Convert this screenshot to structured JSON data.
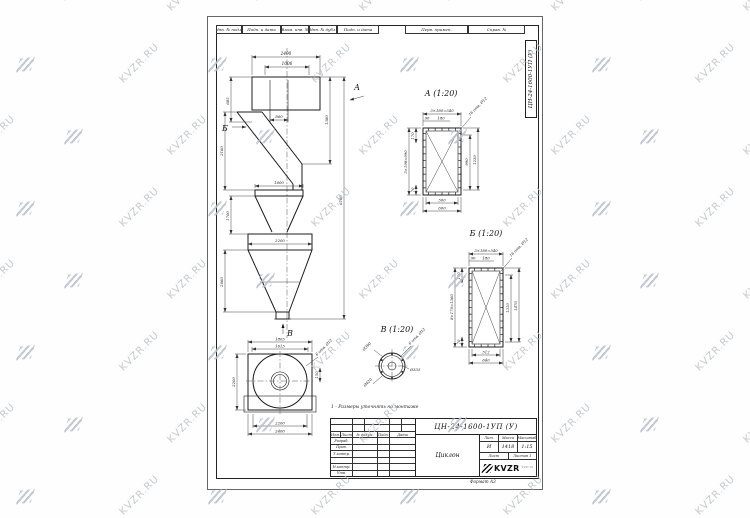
{
  "watermark": {
    "text": "KVZR.RU"
  },
  "sheet": {
    "top_strip": [
      "Инв. № подл.",
      "Подп. и дата",
      "Взам. инв. №",
      "Инв. № дубл.",
      "Подп. и дата"
    ],
    "top_right_cells": [
      "Перв. примен.",
      "Справ. №"
    ],
    "side_doc_number": "ЦН-24-1600-1УП (У)"
  },
  "front_view": {
    "label_a": "А",
    "label_b": "Б",
    "label_v": "В",
    "d2400": "2400",
    "d1006": "1006",
    "d860": "860",
    "d1600": "1600",
    "d2200": "2200",
    "l1": "685",
    "l2": "2160",
    "l3": "1700",
    "l4": "2060",
    "r1": "1380",
    "r2": "6160"
  },
  "section_a": {
    "title": "А (1:20)",
    "d540": "3×180=540",
    "d90": "90",
    "d180": "180",
    "holes": "16 отв. Ø12",
    "dleft": "5×198=990",
    "d170": "170",
    "d70": "70",
    "d990": "990",
    "d1230": "1230",
    "d500": "500",
    "d600": "600"
  },
  "section_b": {
    "title": "Б (1:20)",
    "d540": "3×180=540",
    "d90": "90",
    "d180": "180",
    "holes": "16 отв. Ø12",
    "dleft": "8×170=1360",
    "d170": "170",
    "d70": "70",
    "d1310": "1310",
    "d1470": "1470",
    "d512": "512",
    "d640": "640"
  },
  "section_v": {
    "title": "В (1:20)",
    "holes": "6 отв. Ø12",
    "d1": "Ø390",
    "d2": "Ø335",
    "d3": "Ø420"
  },
  "plan_view": {
    "d1805": "1805",
    "d1615": "1615",
    "dleft": "2200",
    "d2200": "2200",
    "d2400": "2400",
    "d150": "150",
    "holes": "6 отв. Ø12"
  },
  "note": "1 - Размеры уточнять на монтаже",
  "title_block": {
    "doc_number": "ЦН-24-1600-1УП (У)",
    "name": "Циклон",
    "cols": [
      "Изм.",
      "Лист",
      "№ докум.",
      "Подп.",
      "Дата"
    ],
    "rows": [
      "Разраб.",
      "Пров.",
      "Т.контр.",
      "",
      "Н.контр.",
      "Утв."
    ],
    "headers": {
      "lit": "Лит.",
      "mass": "Масса",
      "scale": "Масштаб",
      "sheet": "Лист",
      "sheets": "Листов"
    },
    "values": {
      "lit": "И",
      "mass": "1418",
      "scale": "1:15",
      "sheets": "1"
    },
    "logo": "KVZR",
    "logo_note": "kvzr.ru",
    "format": "Формат А3"
  }
}
